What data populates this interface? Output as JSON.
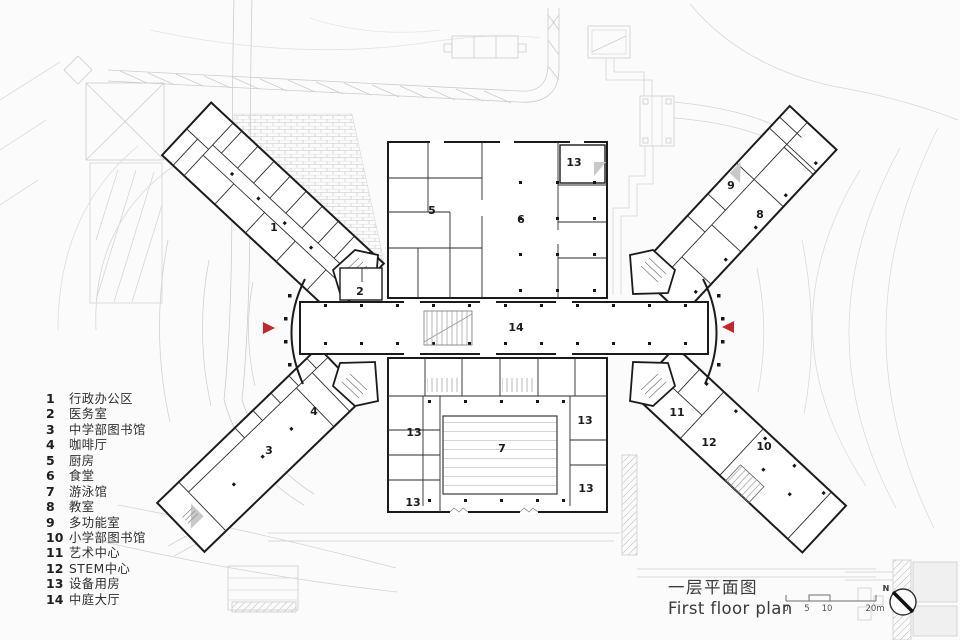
{
  "title": {
    "zh": "一层平面图",
    "en": "First floor plan"
  },
  "legend": {
    "items": [
      {
        "num": "1",
        "label": "行政办公区"
      },
      {
        "num": "2",
        "label": "医务室"
      },
      {
        "num": "3",
        "label": "中学部图书馆"
      },
      {
        "num": "4",
        "label": "咖啡厅"
      },
      {
        "num": "5",
        "label": "厨房"
      },
      {
        "num": "6",
        "label": "食堂"
      },
      {
        "num": "7",
        "label": "游泳馆"
      },
      {
        "num": "8",
        "label": "教室"
      },
      {
        "num": "9",
        "label": "多功能室"
      },
      {
        "num": "10",
        "label": "小学部图书馆"
      },
      {
        "num": "11",
        "label": "艺术中心"
      },
      {
        "num": "12",
        "label": "STEM中心"
      },
      {
        "num": "13",
        "label": "设备用房"
      },
      {
        "num": "14",
        "label": "中庭大厅"
      }
    ]
  },
  "scale_bar": {
    "labels": [
      "0",
      "5",
      "10",
      "20m"
    ]
  },
  "north": {
    "label": "N"
  },
  "plan": {
    "room_labels": [
      {
        "num": "1",
        "x": 274,
        "y": 231
      },
      {
        "num": "2",
        "x": 360,
        "y": 295
      },
      {
        "num": "3",
        "x": 269,
        "y": 454
      },
      {
        "num": "4",
        "x": 314,
        "y": 415
      },
      {
        "num": "5",
        "x": 432,
        "y": 214
      },
      {
        "num": "6",
        "x": 521,
        "y": 223
      },
      {
        "num": "7",
        "x": 502,
        "y": 452
      },
      {
        "num": "8",
        "x": 760,
        "y": 218
      },
      {
        "num": "9",
        "x": 731,
        "y": 189
      },
      {
        "num": "10",
        "x": 764,
        "y": 450
      },
      {
        "num": "11",
        "x": 677,
        "y": 416
      },
      {
        "num": "12",
        "x": 709,
        "y": 446
      },
      {
        "num": "13",
        "x": 574,
        "y": 166
      },
      {
        "num": "13",
        "x": 414,
        "y": 436
      },
      {
        "num": "13",
        "x": 413,
        "y": 506
      },
      {
        "num": "13",
        "x": 585,
        "y": 424
      },
      {
        "num": "13",
        "x": 586,
        "y": 492
      },
      {
        "num": "14",
        "x": 516,
        "y": 331
      }
    ],
    "entrance_arrows": [
      {
        "x": 269,
        "y": 328,
        "dir": "right"
      },
      {
        "x": 728,
        "y": 327,
        "dir": "left"
      }
    ],
    "colors": {
      "wall": "#1b1b1b",
      "context": "#cdcdcd",
      "accent_red": "#c1272d"
    }
  }
}
